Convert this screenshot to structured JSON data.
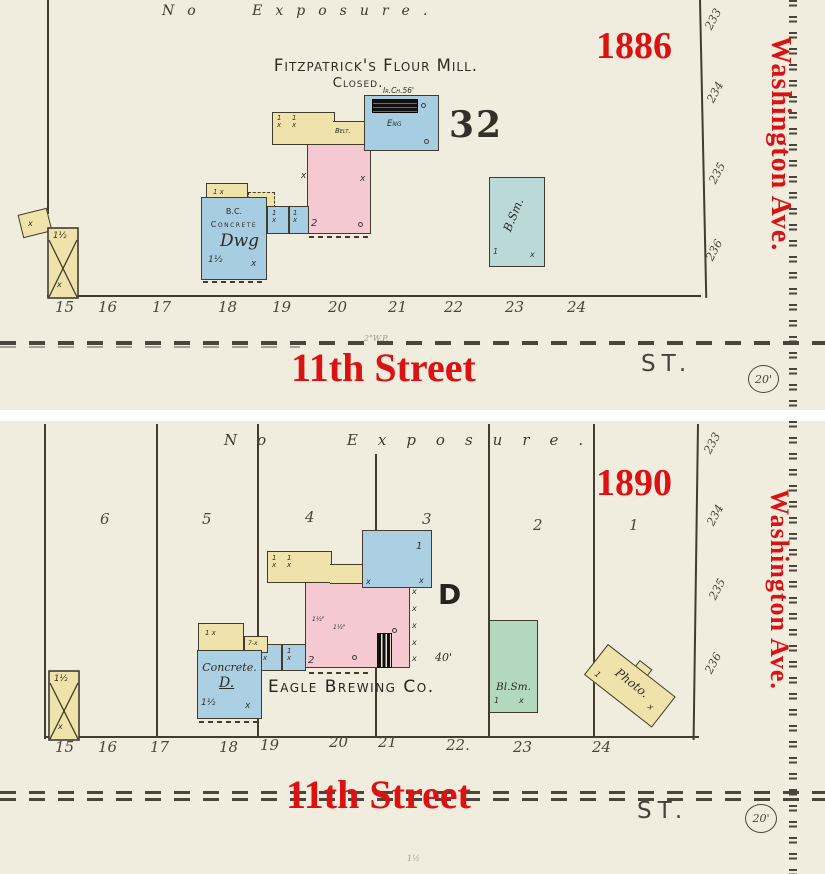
{
  "map_1886": {
    "year": "1886",
    "no_exposure": "No Exposure.",
    "title": "Fitzpatrick's Flour Mill.",
    "subtitle": "Closed.",
    "chimney_note": "Ir.Ch.56'",
    "block_number": "32",
    "belt_label": "Belt.",
    "eng_label": "Eng",
    "bc_label": "B.C.",
    "concrete_label": "Concrete",
    "dwg_label": "Dwg",
    "stories_concrete": "1½",
    "stories_pink": "2",
    "stories_x_building": "1½",
    "bsm_label": "B.Sm.",
    "street_name": "11th Street",
    "street_abbrev": "ST.",
    "street_width": "20'",
    "avenue_name": "Washington Ave.",
    "water_note": "2\"W.P.",
    "lots": [
      "15",
      "16",
      "17",
      "18",
      "19",
      "20",
      "21",
      "22",
      "23",
      "24"
    ],
    "block_edge_numbers": [
      "233",
      "234",
      "235",
      "236"
    ]
  },
  "map_1890": {
    "year": "1890",
    "no_exposure": "No Exposure.",
    "company": "Eagle Brewing Co.",
    "district_letter": "D",
    "dimension": "40'",
    "concrete_label": "Concrete.",
    "concrete_d": "D.",
    "stories_concrete": "1½",
    "stories_pink": "2",
    "stories_x_building": "1½",
    "stories_blue": "1",
    "blacksmith_label": "Bl.Sm.",
    "photo_label": "Photo.",
    "pipe_note": "1½",
    "street_name": "11th Street",
    "street_abbrev": "ST.",
    "street_width": "20'",
    "avenue_name": "Washington Ave.",
    "lots_top": [
      "6",
      "5",
      "4",
      "3",
      "2",
      "1"
    ],
    "lots": [
      "15",
      "16",
      "17",
      "18",
      "19",
      "20",
      "21",
      "22.",
      "23",
      "24"
    ],
    "block_edge_numbers": [
      "233",
      "234",
      "235",
      "236"
    ]
  },
  "marks": {
    "x": "x",
    "one": "1",
    "one_x": "1\nx",
    "one_x_row": "1   x",
    "seven_x": "7-x",
    "hose": "1½\""
  },
  "colors": {
    "annotation_red": "#dc1212",
    "paper": "#f0ecde",
    "ink": "#423c2d",
    "building_yellow": "#efe3ab",
    "building_pink": "#f4c9d1",
    "building_blue": "#a7cde2",
    "building_teal": "#bcd9da",
    "building_green": "#b2d8bd"
  }
}
